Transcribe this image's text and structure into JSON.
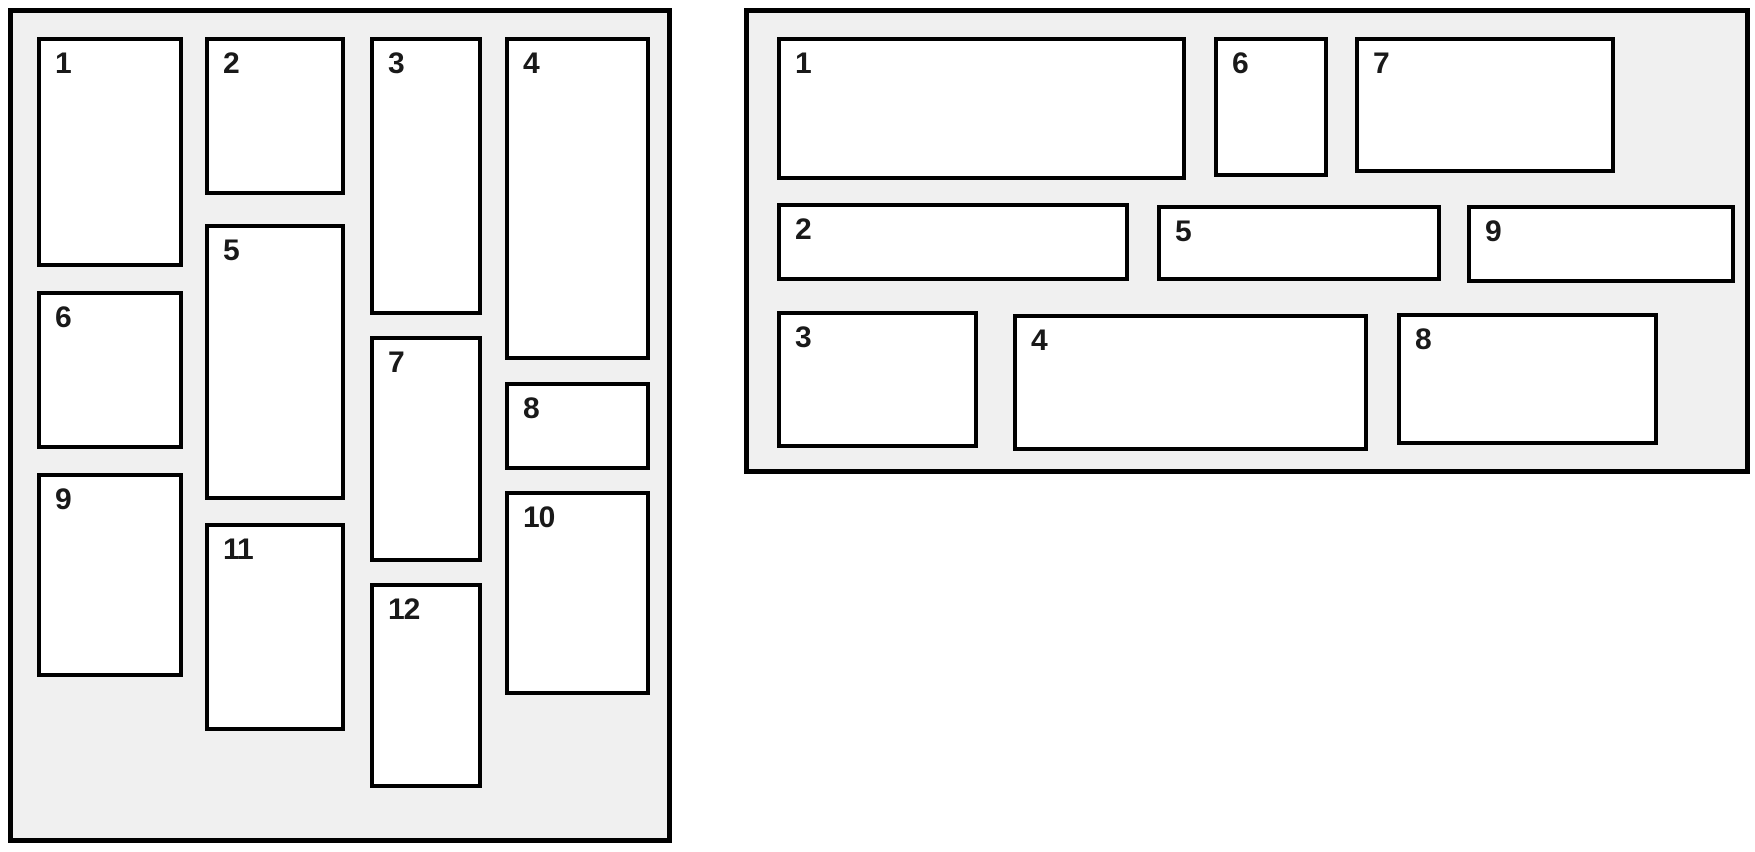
{
  "diagram": {
    "description_colors": {
      "page_background": "#ffffff",
      "panel_background": "#f0f0f0",
      "panel_border": "#000000",
      "box_background": "#ffffff",
      "box_border": "#000000",
      "label_color": "#191919"
    },
    "panels": [
      {
        "id": "panel-vertical-masonry",
        "name": "vertical-masonry-panel",
        "rect": {
          "x": 8,
          "y": 8,
          "w": 664,
          "h": 835
        },
        "boxes": [
          {
            "label": "1",
            "x": 24,
            "y": 24,
            "w": 146,
            "h": 230
          },
          {
            "label": "2",
            "x": 192,
            "y": 24,
            "w": 140,
            "h": 158
          },
          {
            "label": "3",
            "x": 357,
            "y": 24,
            "w": 112,
            "h": 278
          },
          {
            "label": "4",
            "x": 492,
            "y": 24,
            "w": 145,
            "h": 323
          },
          {
            "label": "5",
            "x": 192,
            "y": 211,
            "w": 140,
            "h": 276
          },
          {
            "label": "6",
            "x": 24,
            "y": 278,
            "w": 146,
            "h": 158
          },
          {
            "label": "7",
            "x": 357,
            "y": 323,
            "w": 112,
            "h": 226
          },
          {
            "label": "8",
            "x": 492,
            "y": 369,
            "w": 145,
            "h": 88
          },
          {
            "label": "9",
            "x": 24,
            "y": 460,
            "w": 146,
            "h": 204
          },
          {
            "label": "10",
            "x": 492,
            "y": 478,
            "w": 145,
            "h": 204
          },
          {
            "label": "11",
            "x": 192,
            "y": 510,
            "w": 140,
            "h": 208
          },
          {
            "label": "12",
            "x": 357,
            "y": 570,
            "w": 112,
            "h": 205
          }
        ]
      },
      {
        "id": "panel-horizontal-masonry",
        "name": "horizontal-masonry-panel",
        "rect": {
          "x": 744,
          "y": 8,
          "w": 1006,
          "h": 466
        },
        "boxes": [
          {
            "label": "1",
            "x": 28,
            "y": 24,
            "w": 409,
            "h": 143
          },
          {
            "label": "2",
            "x": 28,
            "y": 190,
            "w": 352,
            "h": 78
          },
          {
            "label": "3",
            "x": 28,
            "y": 298,
            "w": 201,
            "h": 137
          },
          {
            "label": "4",
            "x": 264,
            "y": 301,
            "w": 355,
            "h": 137
          },
          {
            "label": "5",
            "x": 408,
            "y": 192,
            "w": 284,
            "h": 76
          },
          {
            "label": "6",
            "x": 465,
            "y": 24,
            "w": 114,
            "h": 140
          },
          {
            "label": "7",
            "x": 606,
            "y": 24,
            "w": 260,
            "h": 136
          },
          {
            "label": "8",
            "x": 648,
            "y": 300,
            "w": 261,
            "h": 132
          },
          {
            "label": "9",
            "x": 718,
            "y": 192,
            "w": 268,
            "h": 78
          }
        ]
      }
    ]
  }
}
